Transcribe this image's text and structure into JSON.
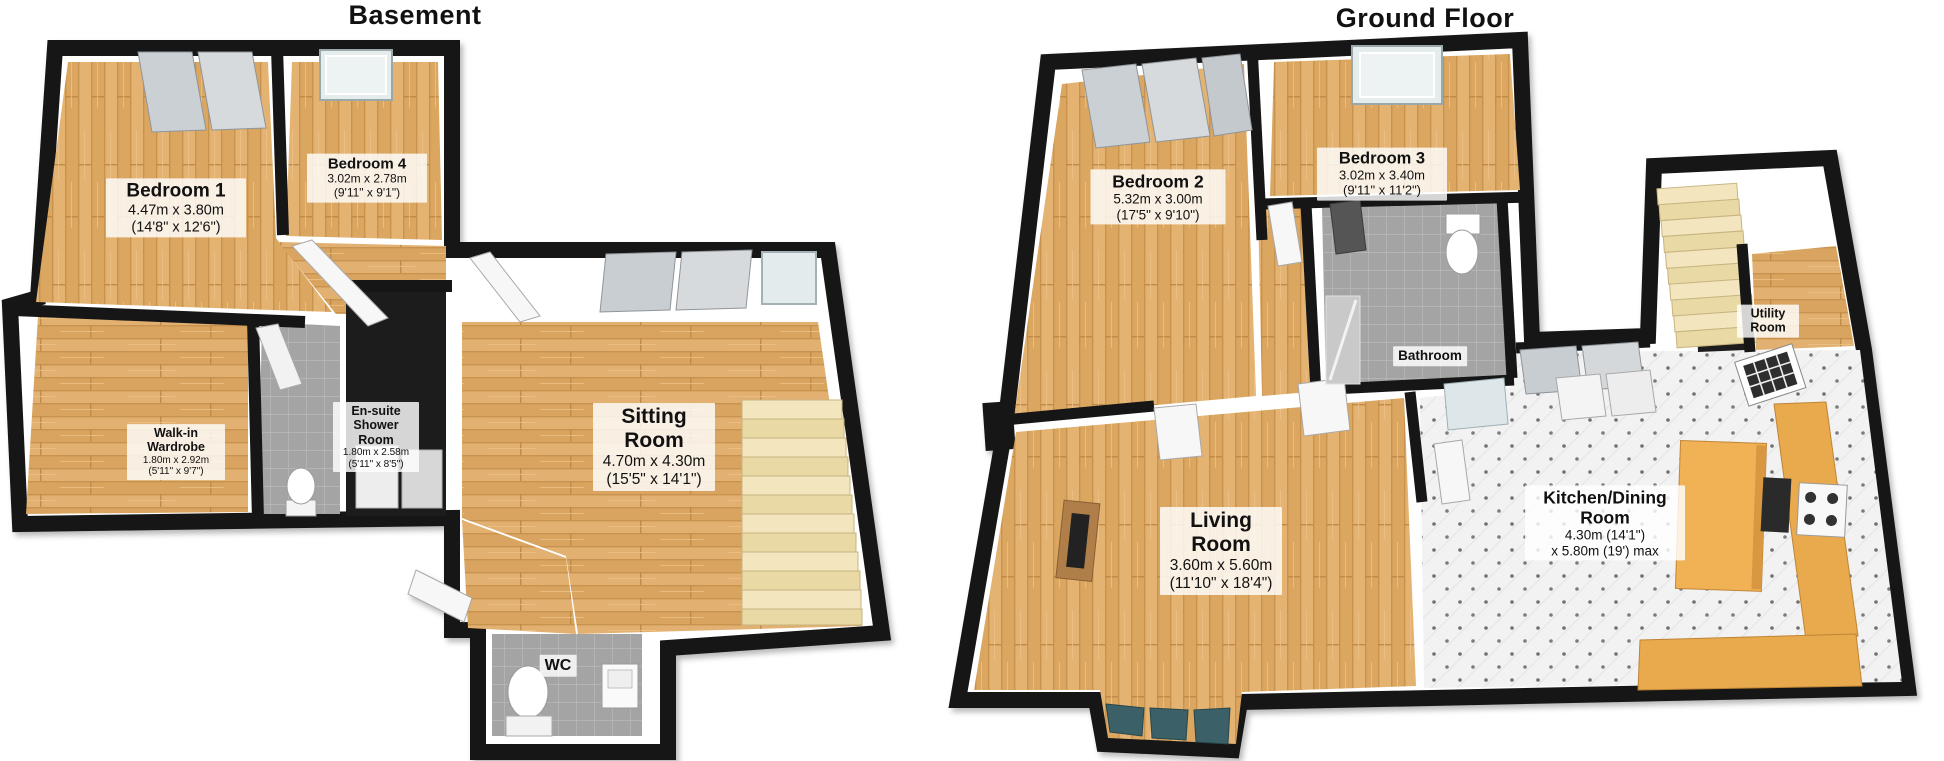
{
  "colors": {
    "wall": "#161616",
    "wall_face": "#ffffff",
    "wood_light": "#EBC286",
    "wood_base": "#DFA963",
    "wood_line": "#C8924F",
    "tile_gray": "#A4A4A4",
    "tile_line": "#BDBDBD",
    "kitchen_floor": "#F2F2F2",
    "kitchen_dot": "#6F6F6F",
    "stair_light": "#F3E6BE",
    "stair_dark": "#E9D9A4",
    "counter": "#E9A94E",
    "island": "#F0B254",
    "wardrobe_panel": "#C9CED2",
    "glass_pale": "#E3EBEC",
    "bay_glass": "#3A6168",
    "label_bg": "rgba(255,255,255,0.82)"
  },
  "plans": [
    {
      "id": "basement",
      "title": "Basement",
      "rooms": [
        {
          "key": "bedroom-1",
          "name": "Bedroom 1",
          "dims1": "4.47m x 3.80m",
          "dims2": "(14'8\" x 12'6\")"
        },
        {
          "key": "bedroom-4",
          "name": "Bedroom 4",
          "dims1": "3.02m x 2.78m",
          "dims2": "(9'11\" x 9'1\")"
        },
        {
          "key": "walk-in-wardrobe",
          "name": "Walk-in Wardrobe",
          "dims1": "1.80m x 2.92m",
          "dims2": "(5'11\" x 9'7\")"
        },
        {
          "key": "en-suite-shower-room",
          "name": "En-suite Shower Room",
          "dims1": "1.80m x 2.58m",
          "dims2": "(5'11\" x 8'5\")"
        },
        {
          "key": "sitting-room",
          "name": "Sitting Room",
          "dims1": "4.70m x 4.30m",
          "dims2": "(15'5\" x 14'1\")"
        },
        {
          "key": "wc",
          "name": "WC"
        }
      ]
    },
    {
      "id": "ground-floor",
      "title": "Ground Floor",
      "rooms": [
        {
          "key": "bedroom-2",
          "name": "Bedroom 2",
          "dims1": "5.32m x 3.00m",
          "dims2": "(17'5\" x 9'10\")"
        },
        {
          "key": "bedroom-3",
          "name": "Bedroom 3",
          "dims1": "3.02m x 3.40m",
          "dims2": "(9'11\" x 11'2\")"
        },
        {
          "key": "bathroom",
          "name": "Bathroom"
        },
        {
          "key": "utility-room",
          "name": "Utility Room"
        },
        {
          "key": "living-room",
          "name": "Living Room",
          "dims1": "3.60m x 5.60m",
          "dims2": "(11'10\" x 18'4\")"
        },
        {
          "key": "kitchen-dining-room",
          "name": "Kitchen/Dining Room",
          "dims1": "4.30m (14'1\")",
          "dims2": "x 5.80m (19') max"
        }
      ]
    }
  ]
}
